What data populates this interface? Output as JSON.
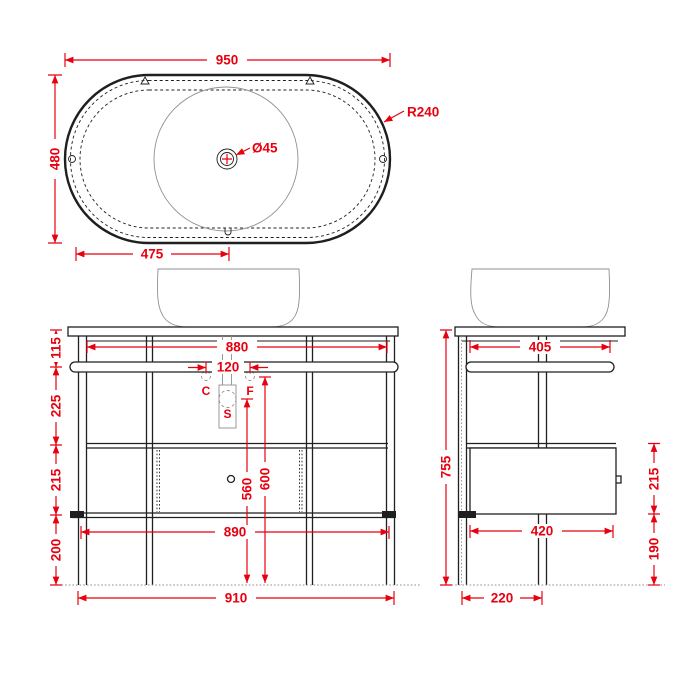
{
  "drawing_title": "washbasin-console-technical-drawing",
  "colors": {
    "dimension": "#e8000f",
    "outline": "#1f1f1f",
    "secondary": "#8f8f8f",
    "background": "#ffffff"
  },
  "views": {
    "top_view": {
      "width": "950",
      "depth": "480",
      "drain_offset": "475",
      "corner_radius": "R240",
      "drain_diameter": "Ø45"
    },
    "front_view": {
      "inner_width": "880",
      "counter_to_rail": "115",
      "rail_to_shelf": "225",
      "shelf_to_frame": "215",
      "frame_to_floor": "200",
      "connector_spacing": "120",
      "label_c": "C",
      "label_f": "F",
      "label_s": "S",
      "siphon_height": "560",
      "connector_height": "600",
      "frame_width": "890",
      "overall_width": "910"
    },
    "side_view": {
      "overall_height": "755",
      "top_depth": "405",
      "box_height": "215",
      "box_to_floor": "190",
      "box_depth": "420",
      "leg_spacing": "220"
    }
  }
}
